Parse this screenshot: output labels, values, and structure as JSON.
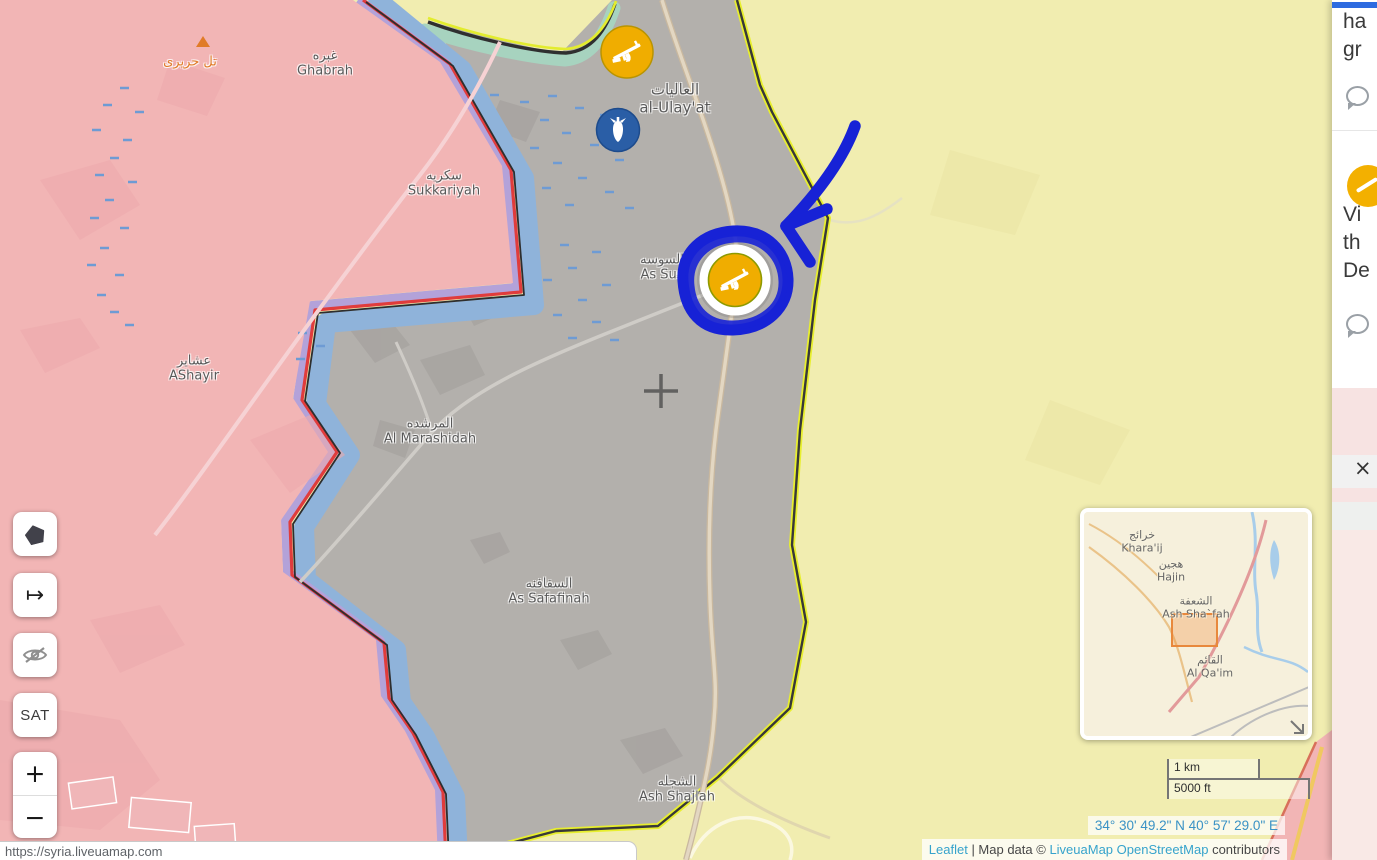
{
  "page": {
    "url_tooltip": "https://syria.liveuamap.com"
  },
  "panel": {
    "accent_color": "#2d6be0",
    "item1": {
      "line1": "ha",
      "line2": "gr"
    },
    "item2": {
      "line1": "Vi",
      "line2": "th",
      "line3": "De"
    },
    "close_label": "×"
  },
  "controls": {
    "satellite_label": "SAT",
    "zoom_in_label": "+",
    "zoom_out_label": "−",
    "jump_glyph": "↦"
  },
  "map": {
    "territory_colors": {
      "pink": "#f2b5b5",
      "gray": "#b3b0ac",
      "yellow": "#f1edb0",
      "frontline_red": "#e03c3c",
      "frontline_dark": "#2e2e2e",
      "river": "#8fb3da",
      "purple_band": "#b3a2d9",
      "boundary_yellow": "#e8ef2e",
      "teal_band": "#a7d3bf"
    },
    "marker_colors": {
      "rifle_bg": "#f0ad00",
      "airstrike_bg": "#2a5ea6"
    },
    "annotation_color": "#1722d6",
    "labels": {
      "tal": {
        "ar": "تل حريرى"
      },
      "ghabrah": {
        "ar": "غبره",
        "en": "Ghabrah"
      },
      "sukkariyah": {
        "ar": "سكريه",
        "en": "Sukkariyah"
      },
      "ashayir": {
        "ar": "عشاير",
        "en": "AShayir"
      },
      "marashidah": {
        "ar": "المرشده",
        "en": "Al Marashidah"
      },
      "safafinah": {
        "ar": "السفافنه",
        "en": "As Safafinah"
      },
      "shajlah": {
        "ar": "الشجله",
        "en": "Ash Shajlah"
      },
      "ulayat": {
        "ar": "العاليات",
        "en": "al-Ulay'at"
      },
      "susah": {
        "ar": "السوسه",
        "en": "As Sus"
      }
    },
    "markers": [
      {
        "type": "rifle-clash",
        "x": 627,
        "y": 52
      },
      {
        "type": "airstrike-bomb",
        "x": 618,
        "y": 130
      },
      {
        "type": "rifle-clash",
        "x": 735,
        "y": 280,
        "selected": true
      }
    ]
  },
  "minimap": {
    "labels": {
      "kharaij": {
        "ar": "خرائج",
        "en": "Khara'ij"
      },
      "hajin": {
        "ar": "هجين",
        "en": "Hajin"
      },
      "ashshafah": {
        "ar": "الشعفة",
        "en": "Ash Sha`fah"
      },
      "alqaim": {
        "ar": "القائم",
        "en": "Al Qa'im"
      }
    }
  },
  "scale": {
    "km": "1 km",
    "ft": "5000 ft"
  },
  "coordinates": "34° 30' 49.2\" N 40° 57' 29.0\" E",
  "attribution": {
    "leaflet": "Leaflet",
    "mapdata": " | Map data © ",
    "liveuamap": "LiveuaMap",
    "osm": "OpenStreetMap",
    "contributors": " contributors"
  }
}
